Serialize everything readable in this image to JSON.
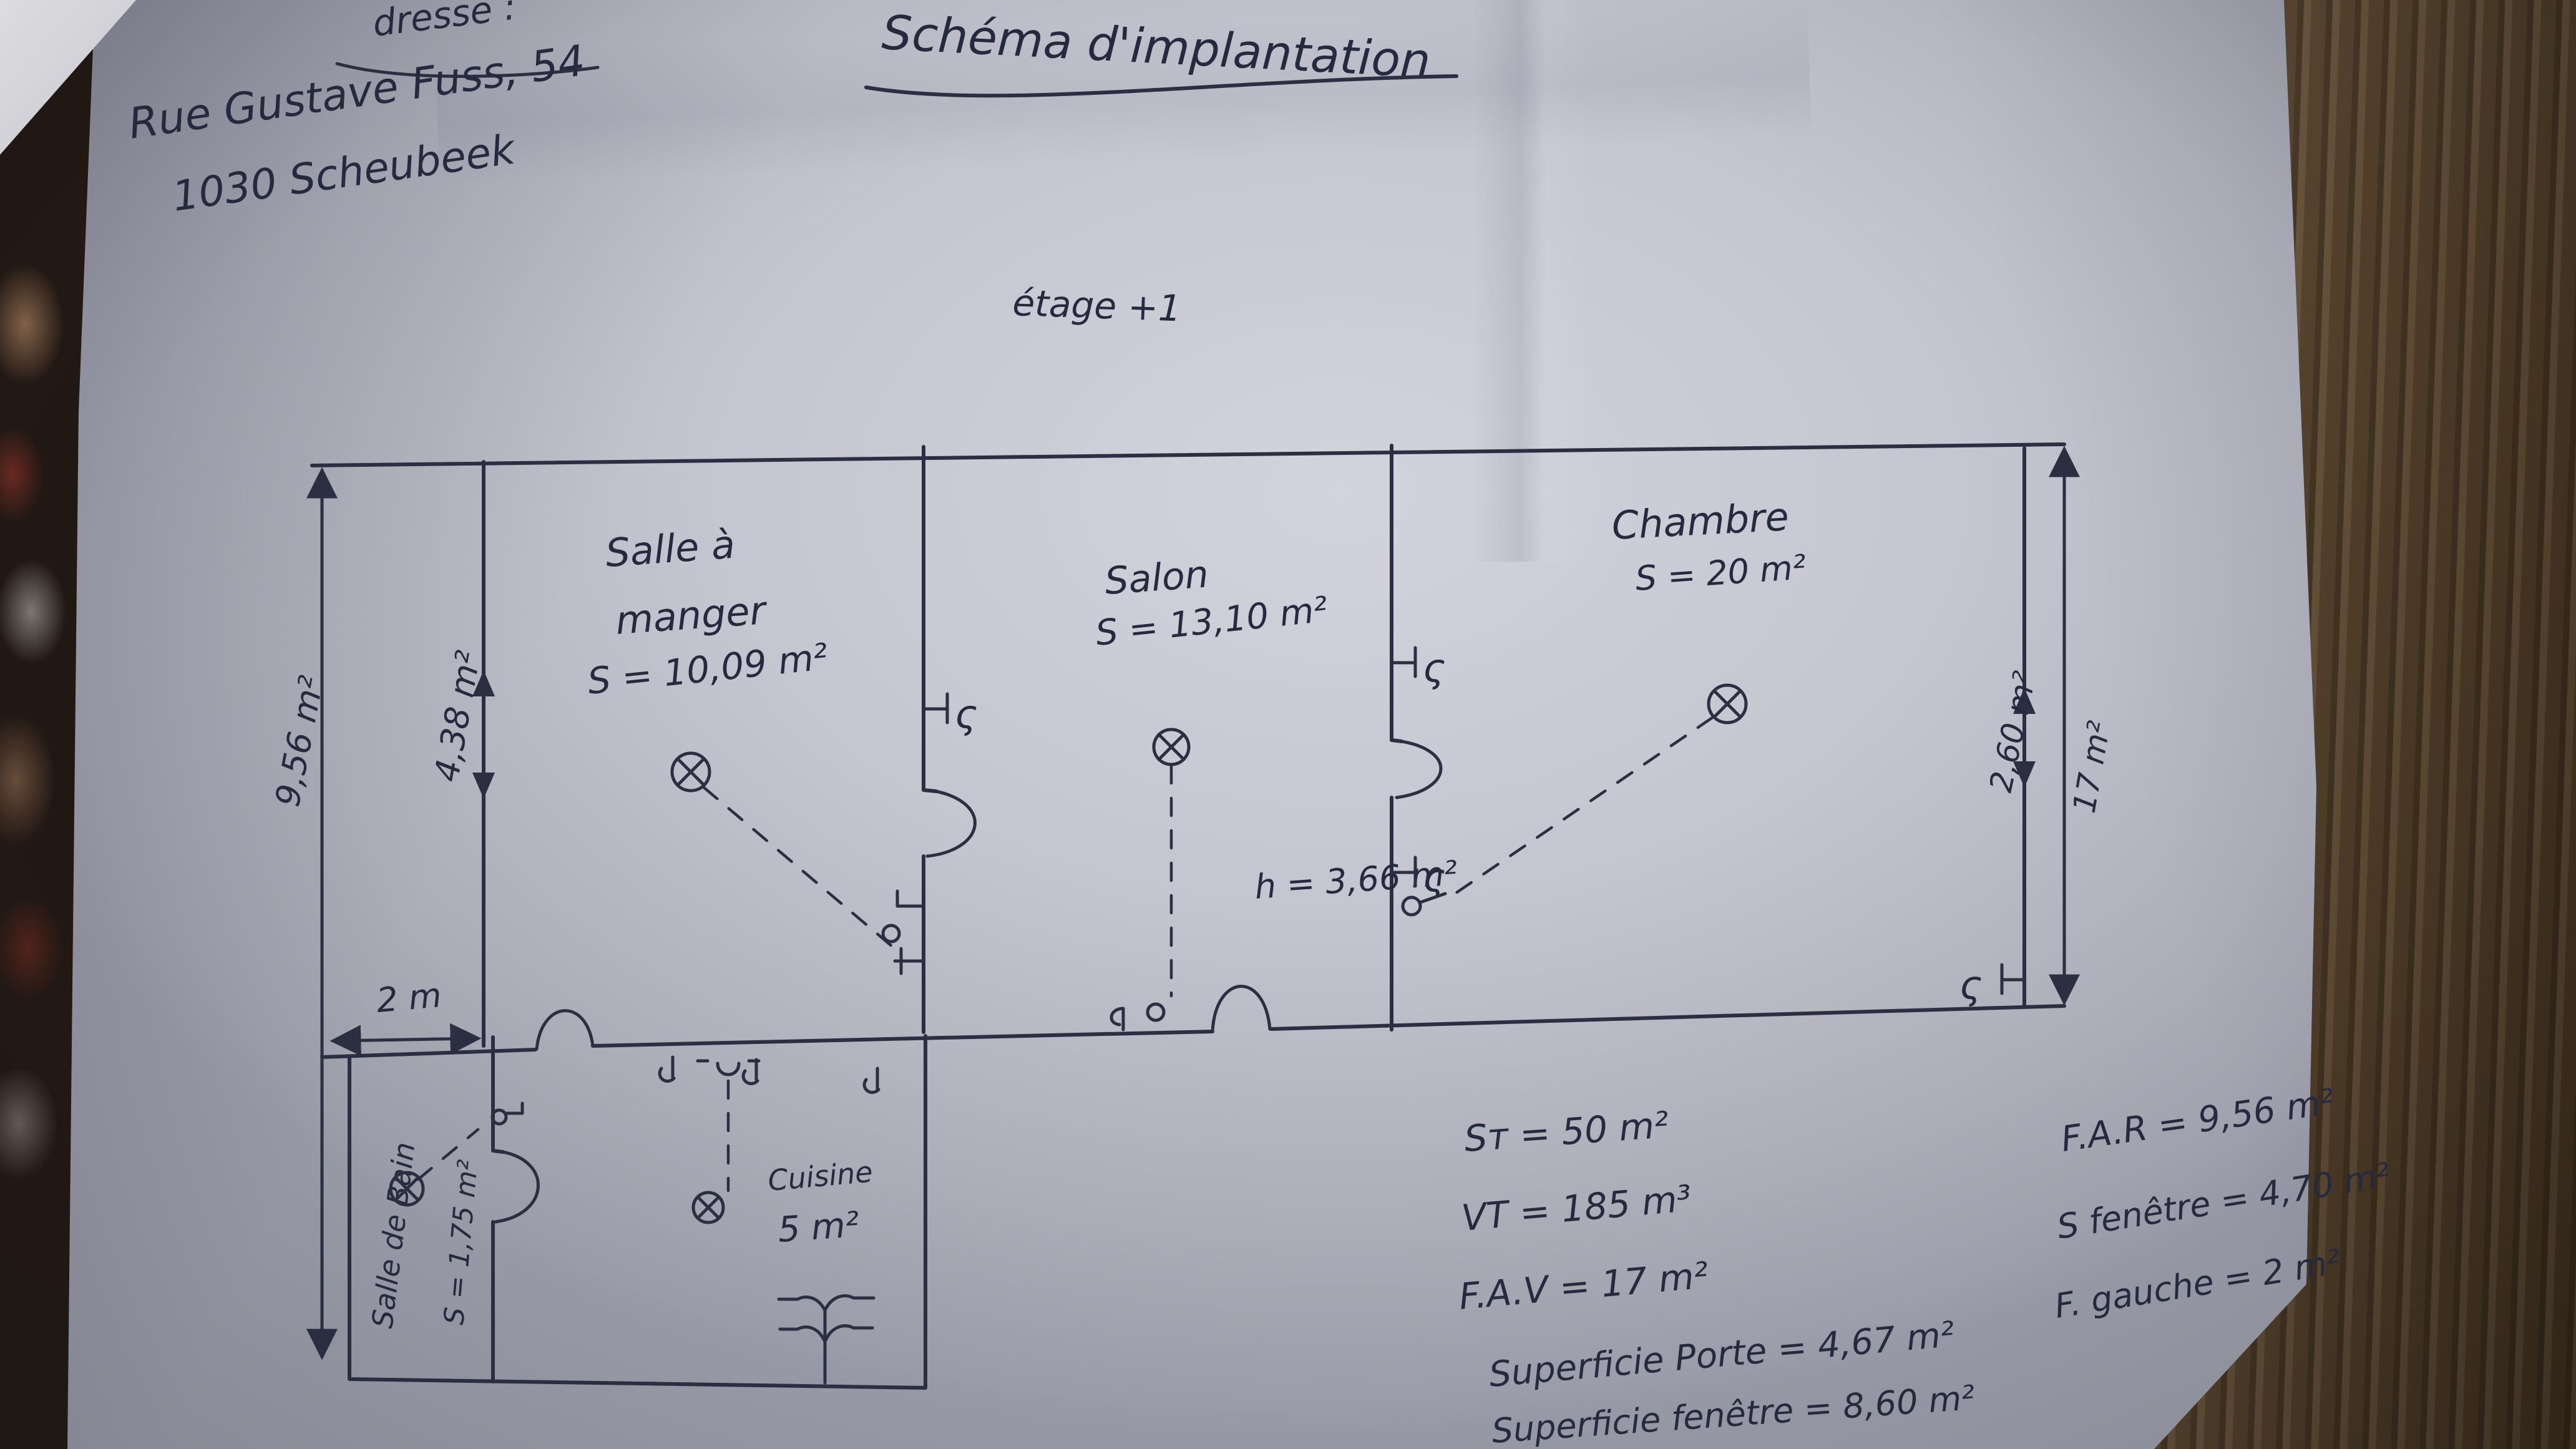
{
  "photo": {
    "paper_color": "#c6c7d2",
    "ink_color": "#2c2f42",
    "wood_color": "#54422b",
    "cloth_color": "#221813"
  },
  "header": {
    "address_label": "dresse :",
    "address_line1": "Rue Gustave Fuss, 54",
    "address_line2": "1030 Scheubeek",
    "title": "Schéma d'implantation",
    "floor_label": "étage +1"
  },
  "rooms": {
    "dining": {
      "name_line1": "Salle à",
      "name_line2": "manger",
      "area": "S = 10,09 m²"
    },
    "living": {
      "name": "Salon",
      "area": "S = 13,10 m²"
    },
    "bedroom": {
      "name": "Chambre",
      "area": "S = 20 m²"
    },
    "kitchen": {
      "name": "Cuisine",
      "area": "5 m²"
    },
    "bathroom": {
      "name": "Salle de Bain",
      "area": "S = 1,75 m²"
    },
    "ceiling_height": "h = 3,66 m²"
  },
  "dimensions": {
    "rear_facade": "9,56 m²",
    "inner_height": "4,38 m²",
    "bath_width": "2 m",
    "window_right": "2,60 m²",
    "front_facade": "17 m²"
  },
  "summary_center": {
    "lines": [
      "Sᴛ = 50 m²",
      "VT = 185 m³",
      "F.A.V = 17 m²",
      "Superficie Porte = 4,67 m²",
      "Superficie fenêtre = 8,60 m²"
    ]
  },
  "summary_right": {
    "lines": [
      "F.A.R = 9,56 m²",
      "S fenêtre = 4,70 m²",
      "F. gauche = 2 m²"
    ]
  },
  "icons": {
    "switch_glyph": "ς"
  }
}
